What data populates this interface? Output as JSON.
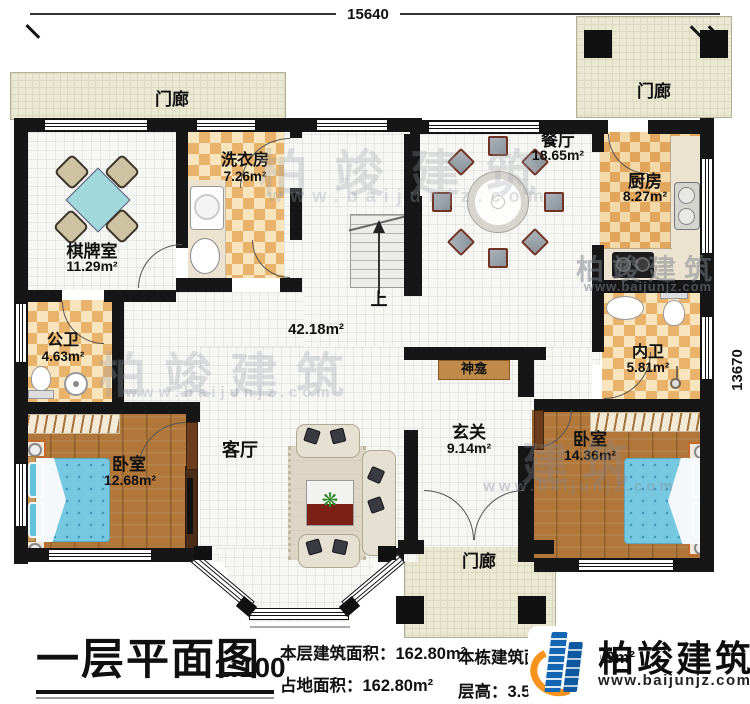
{
  "dimensions": {
    "top_width": "15640",
    "right_height": "13670"
  },
  "rooms": {
    "porch_top_left": {
      "name": "门廊"
    },
    "porch_top_right": {
      "name": "门廊"
    },
    "porch_bottom": {
      "name": "门廊"
    },
    "chess_room": {
      "name": "棋牌室",
      "area": "11.29m²"
    },
    "laundry_room": {
      "name": "洗衣房",
      "area": "7.26m²"
    },
    "dining_room": {
      "name": "餐厅",
      "area": "18.65m²"
    },
    "kitchen": {
      "name": "厨房",
      "area": "8.27m²"
    },
    "public_bathroom": {
      "name": "公卫",
      "area": "4.63m²"
    },
    "bedroom_left": {
      "name": "卧室",
      "area": "12.68m²"
    },
    "living_room": {
      "name": "客厅"
    },
    "entry_hall": {
      "name": "玄关",
      "area": "9.14m²"
    },
    "shrine": {
      "name": "神龛"
    },
    "inner_bathroom": {
      "name": "内卫",
      "area": "5.81m²"
    },
    "bedroom_right": {
      "name": "卧室",
      "area": "14.36m²"
    },
    "open_area": {
      "area": "42.18m²"
    },
    "stairs": {
      "direction_label": "上"
    }
  },
  "title_block": {
    "title": "一层平面图",
    "scale": "1:100",
    "floor_area_label": "本层建筑面积：",
    "floor_area_value": "162.80m²",
    "footprint_label": "占地面积：",
    "footprint_value": "162.80m²",
    "total_area_label": "本栋建筑面积：",
    "total_area_value": "399.9m²",
    "story_height_label": "层高：",
    "story_height_value": "3.5m"
  },
  "branding": {
    "company": "柏竣建筑",
    "website": "www.baijunjz.com"
  },
  "watermark": {
    "text": "柏竣建筑",
    "short_text": "建筑",
    "website": "www.baijunjz.com"
  },
  "colors": {
    "wall": "#161616",
    "tile_dark": "#e9b36b",
    "tile_light": "#f8e5bd",
    "wood": "#b0763a",
    "porch": "#eae7d2",
    "bed_blue": "#76c8e0",
    "brand_blue": "#1266b3",
    "brand_orange": "#f7941d"
  }
}
